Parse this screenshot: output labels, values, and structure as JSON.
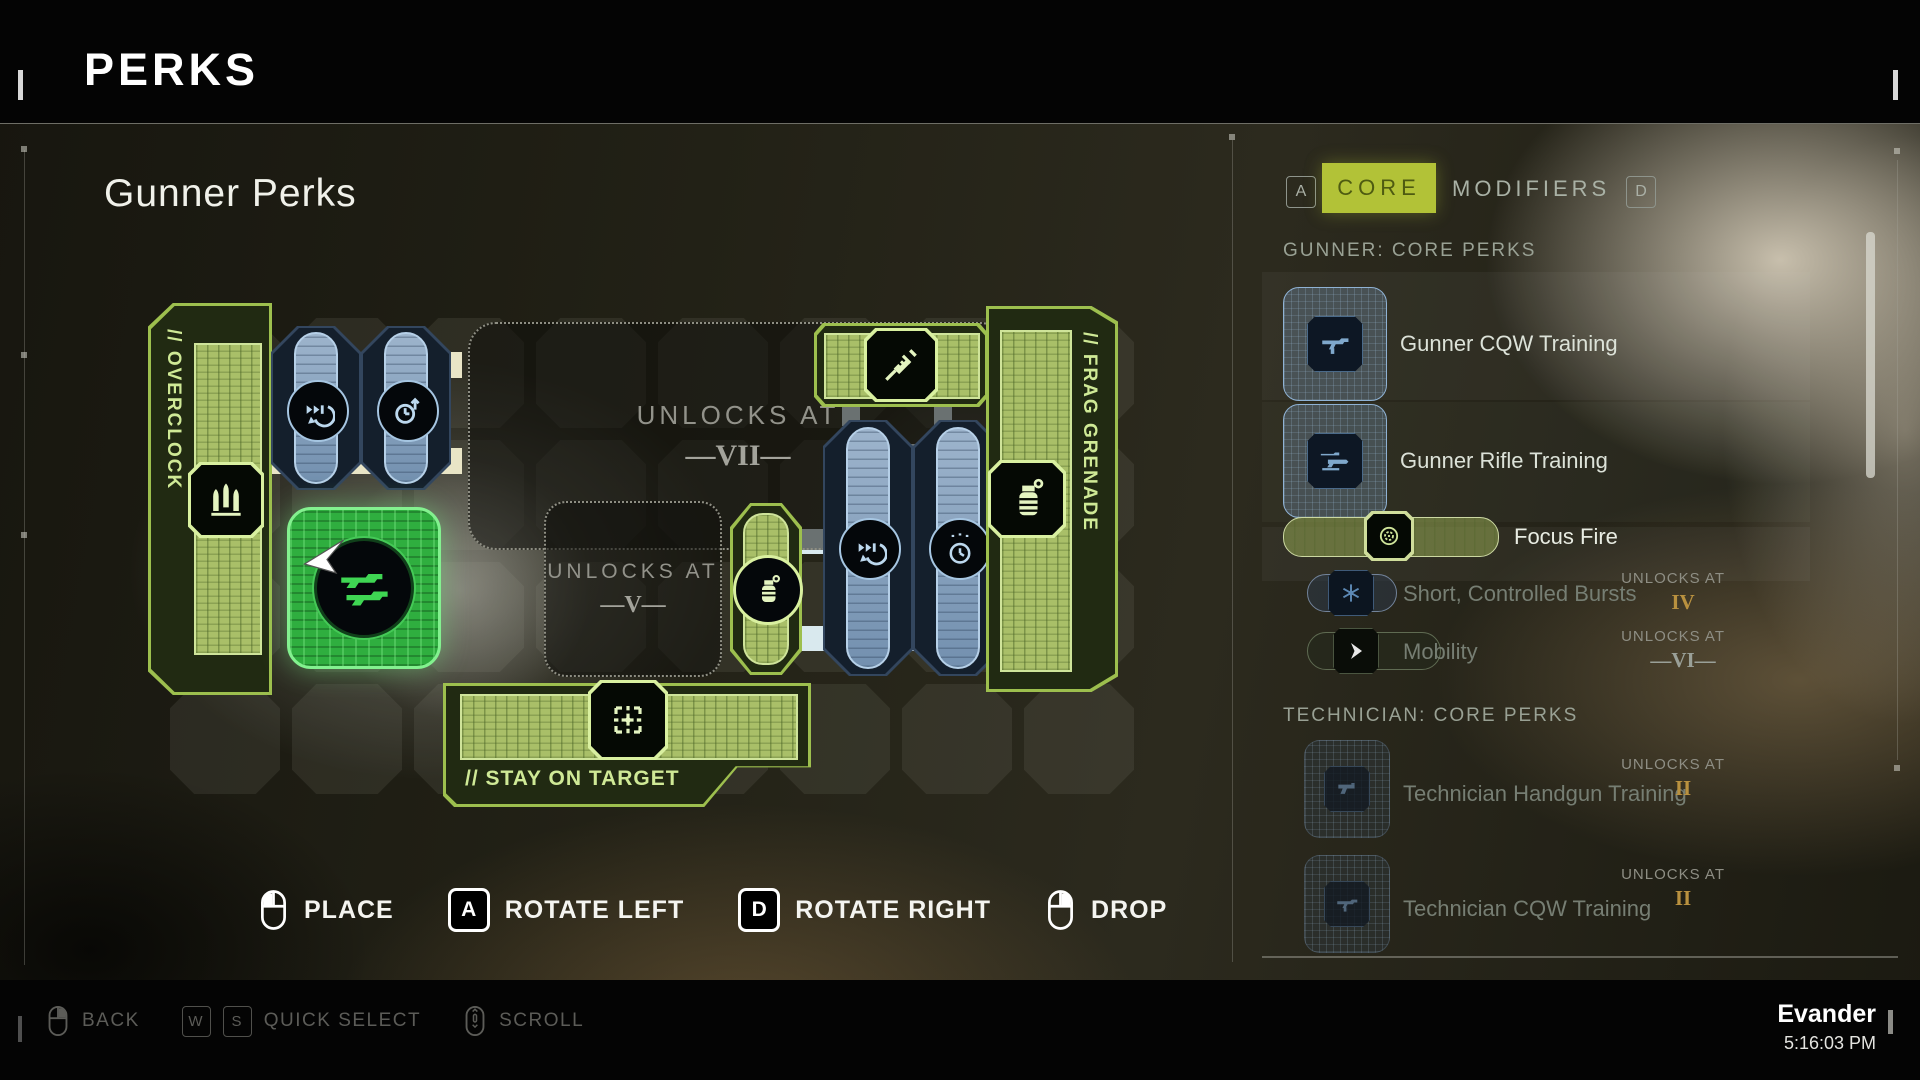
{
  "header": {
    "title": "PERKS"
  },
  "board": {
    "title": "Gunner Perks",
    "pieces": {
      "overclock": {
        "label": "// OVERCLOCK"
      },
      "frag_grenade": {
        "label": "// FRAG GRENADE"
      },
      "stay_on_target": {
        "label": "// STAY ON TARGET"
      }
    },
    "locked_zones": [
      {
        "label": "UNLOCKS AT",
        "level": "—VII—"
      },
      {
        "label": "UNLOCKS AT",
        "level": "—V—"
      }
    ]
  },
  "controls": [
    {
      "input": "mouse-left",
      "label": "PLACE"
    },
    {
      "input": "key",
      "key": "A",
      "label": "ROTATE LEFT"
    },
    {
      "input": "key",
      "key": "D",
      "label": "ROTATE RIGHT"
    },
    {
      "input": "mouse-right",
      "label": "DROP"
    }
  ],
  "panel": {
    "tabs": {
      "left_key": "A",
      "core": "CORE",
      "modifiers": "MODIFIERS",
      "right_key": "D"
    },
    "sections": [
      {
        "title": "GUNNER: CORE PERKS",
        "items": [
          {
            "name": "Gunner CQW Training"
          },
          {
            "name": "Gunner Rifle Training"
          },
          {
            "name": "Focus Fire"
          },
          {
            "name": "Short, Controlled Bursts",
            "unlocks_label": "UNLOCKS AT",
            "unlocks_at": "IV"
          },
          {
            "name": "Mobility",
            "unlocks_label": "UNLOCKS AT",
            "unlocks_at": "—VI—"
          }
        ]
      },
      {
        "title": "TECHNICIAN: CORE PERKS",
        "items": [
          {
            "name": "Technician Handgun Training",
            "unlocks_label": "UNLOCKS AT",
            "unlocks_at": "II"
          },
          {
            "name": "Technician CQW Training",
            "unlocks_label": "UNLOCKS AT",
            "unlocks_at": "II"
          }
        ]
      }
    ]
  },
  "footer": {
    "hints": [
      {
        "input": "mouse-right",
        "label": "BACK"
      },
      {
        "input": "keys",
        "keys": [
          "W",
          "S"
        ],
        "label": "QUICK SELECT"
      },
      {
        "input": "mouse-scroll",
        "label": "SCROLL"
      }
    ],
    "player": "Evander",
    "time": "5:16:03 PM"
  },
  "colors": {
    "accent_green": "#b2c237",
    "piece_green": "#9dbf4e",
    "piece_blue": "#8fa9c4",
    "gold": "#b9913f"
  }
}
